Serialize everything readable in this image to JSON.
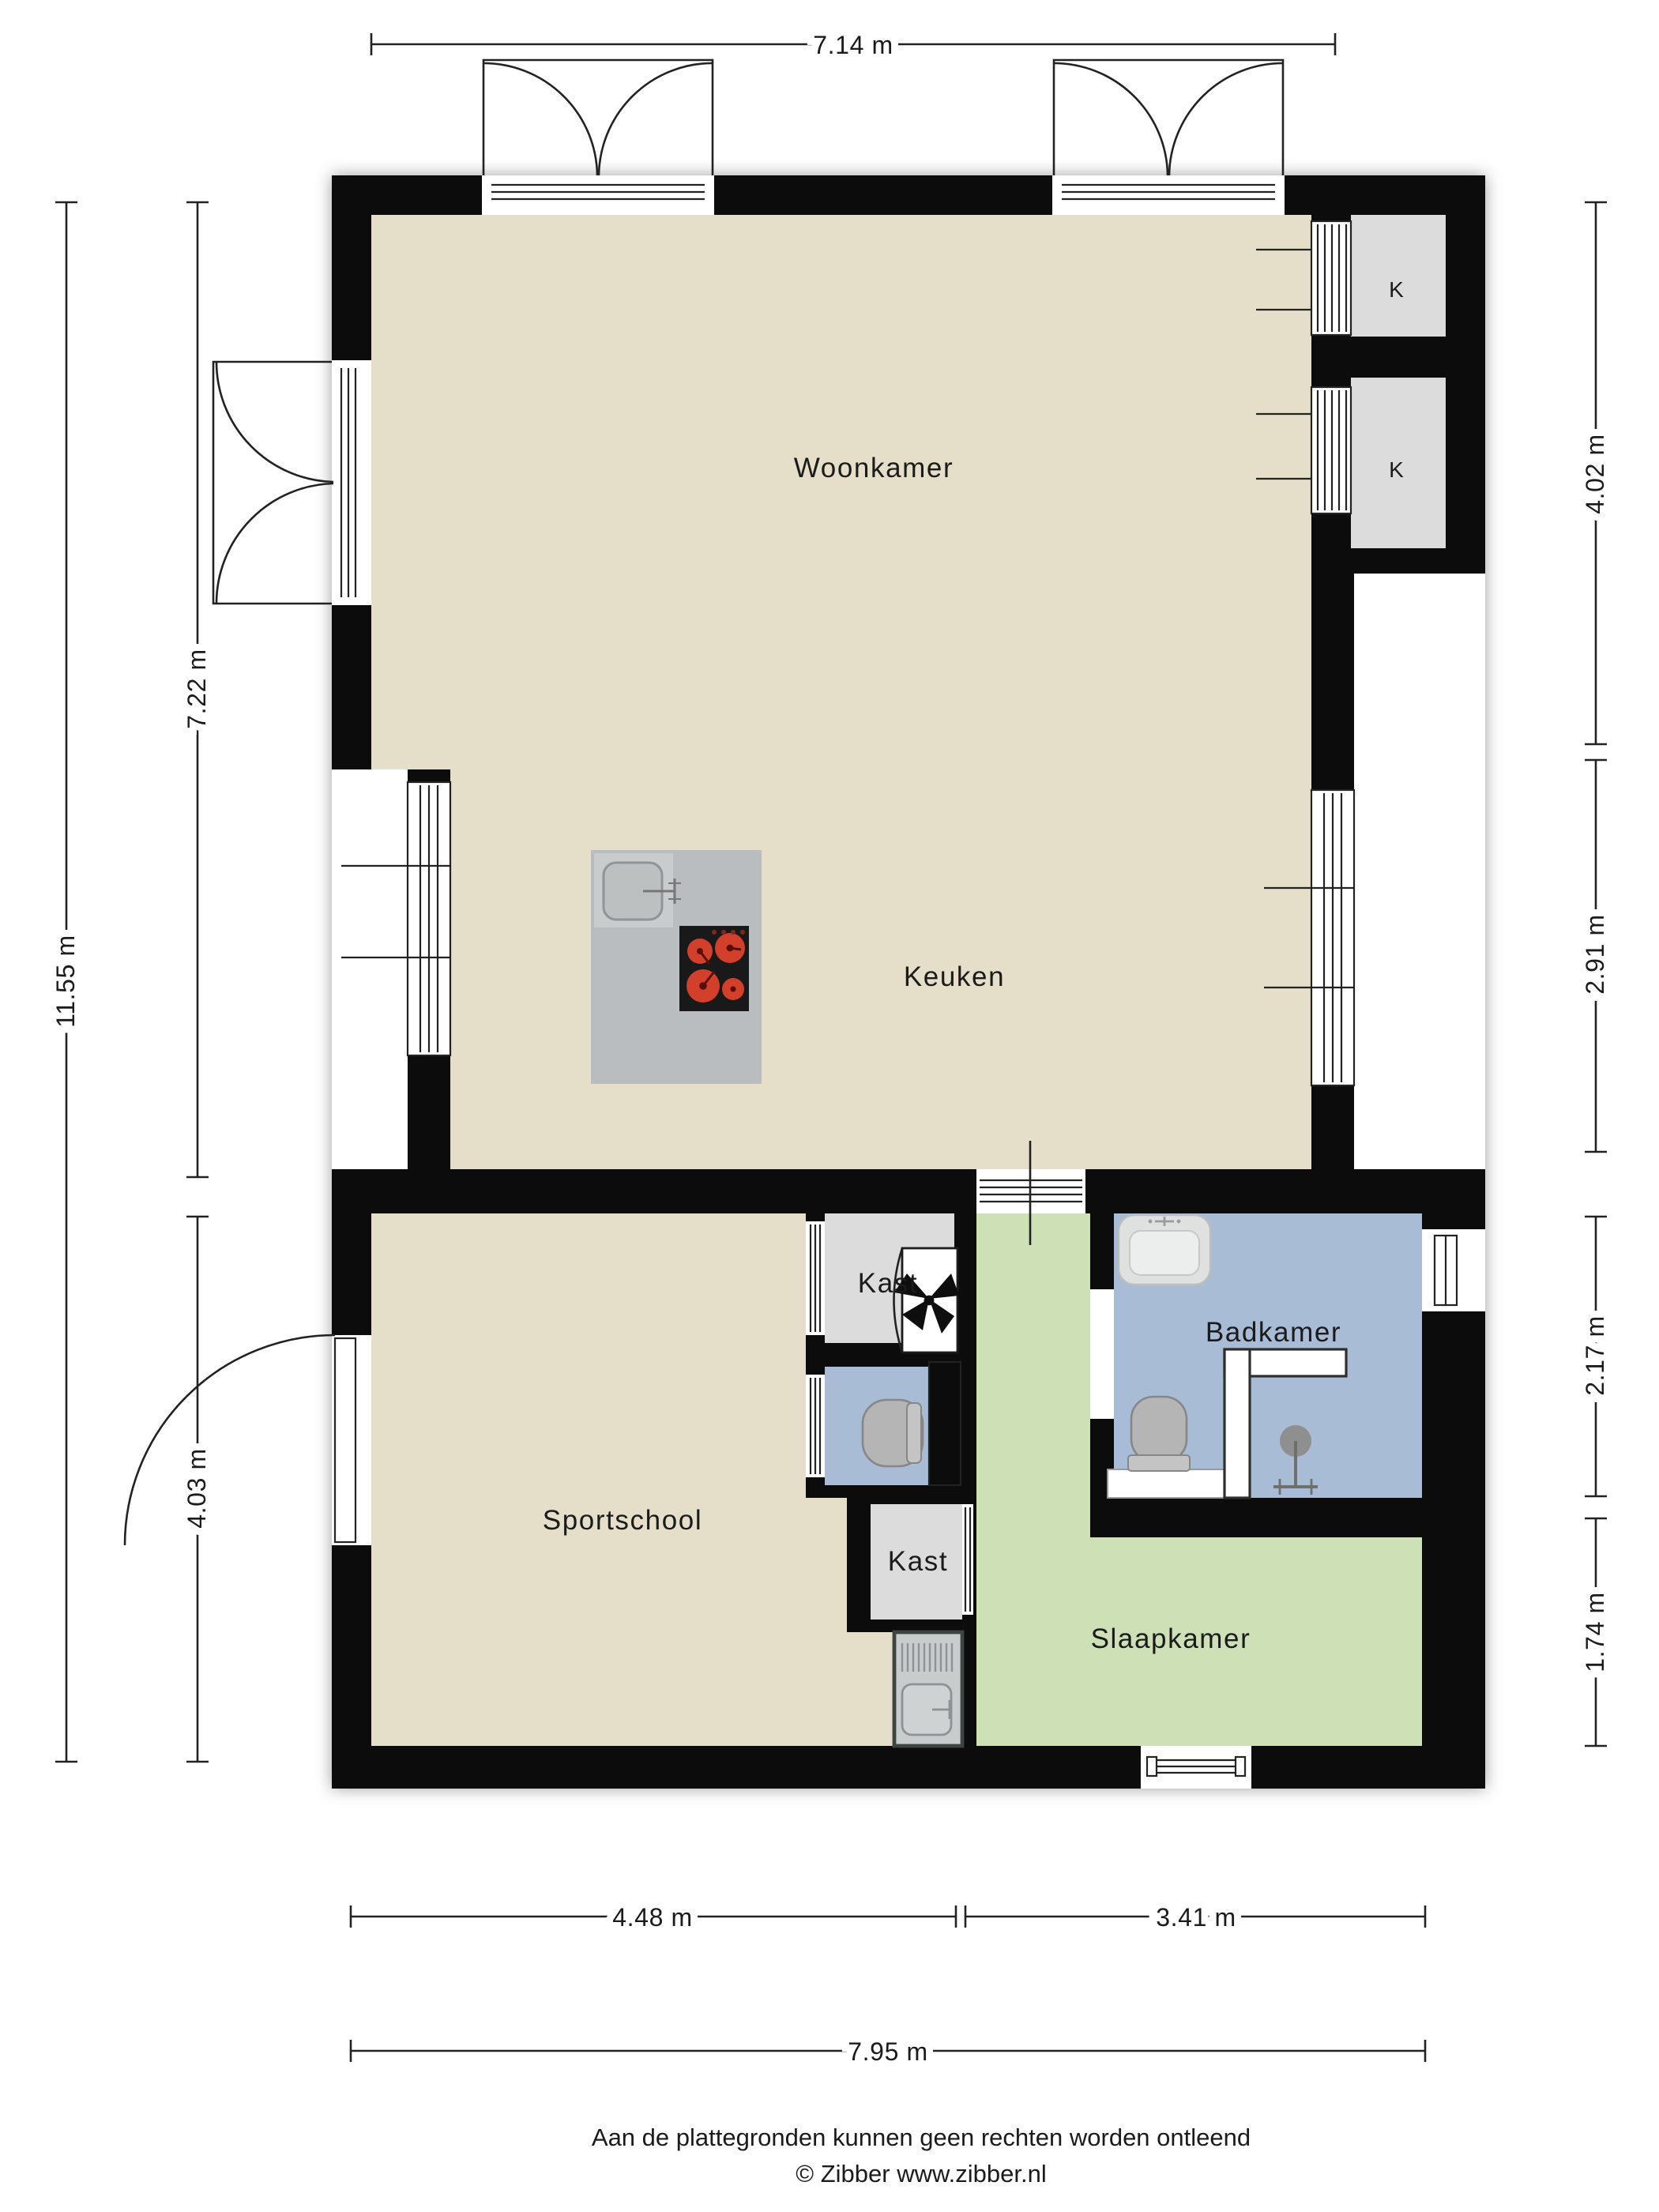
{
  "plan_title": "Floor plan (plattegrond)",
  "rooms": {
    "woonkamer": "Woonkamer",
    "keuken": "Keuken",
    "sportschool": "Sportschool",
    "slaapkamer": "Slaapkamer",
    "badkamer": "Badkamer",
    "kast_upper": "Kast",
    "kast_lower": "Kast",
    "closet_upper": "K",
    "closet_lower": "K"
  },
  "dimensions": {
    "top_width": "7.14 m",
    "left_total_height": "11.55 m",
    "left_upper_height": "7.22 m",
    "left_lower_height": "4.03 m",
    "right_upper_height": "4.02 m",
    "right_middle_height": "2.91 m",
    "right_lower_upper_height": "2.17 m",
    "right_lower_lower_height": "1.74 m",
    "bottom_left_width": "4.48 m",
    "bottom_right_width": "3.41 m",
    "bottom_total_width": "7.95 m"
  },
  "footer": {
    "disclaimer": "Aan de plattegronden kunnen geen rechten worden ontleend",
    "copyright": "© Zibber www.zibber.nl"
  },
  "colors": {
    "wall": "#0c0c0c",
    "floor_living": "#e5dec8",
    "floor_bedroom": "#cde0b6",
    "floor_bath": "#a8bcd5",
    "floor_closet": "#dcdcdc",
    "island": "#b9bdbf",
    "island_sink": "#c9cccc",
    "cooktop": "#191919",
    "burner": "#d2402c",
    "fixture": "#b5b5b5",
    "fixture_light": "#dfe1e1",
    "line": "#222222",
    "text": "#1b1b1b"
  }
}
